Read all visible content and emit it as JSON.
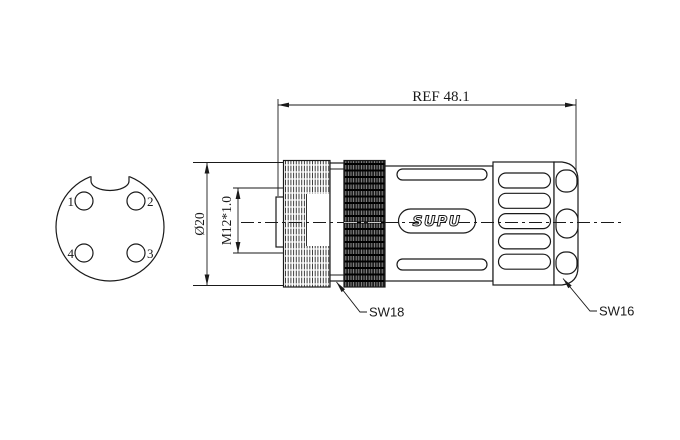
{
  "drawing": {
    "logo_text": "SUPU",
    "colors": {
      "line": "#1a1a1a",
      "background": "#ffffff",
      "knurled_ring_fill": "#1f1f1f"
    },
    "front_view": {
      "pin_labels": {
        "p1": "1",
        "p2": "2",
        "p3": "3",
        "p4": "4"
      }
    },
    "dimensions": {
      "overall_length": "REF 48.1",
      "outer_diameter": "Ø20",
      "thread_spec": "M12*1.0",
      "wrench_size_coupling_nut": "SW18",
      "wrench_size_gland": "SW16"
    }
  }
}
